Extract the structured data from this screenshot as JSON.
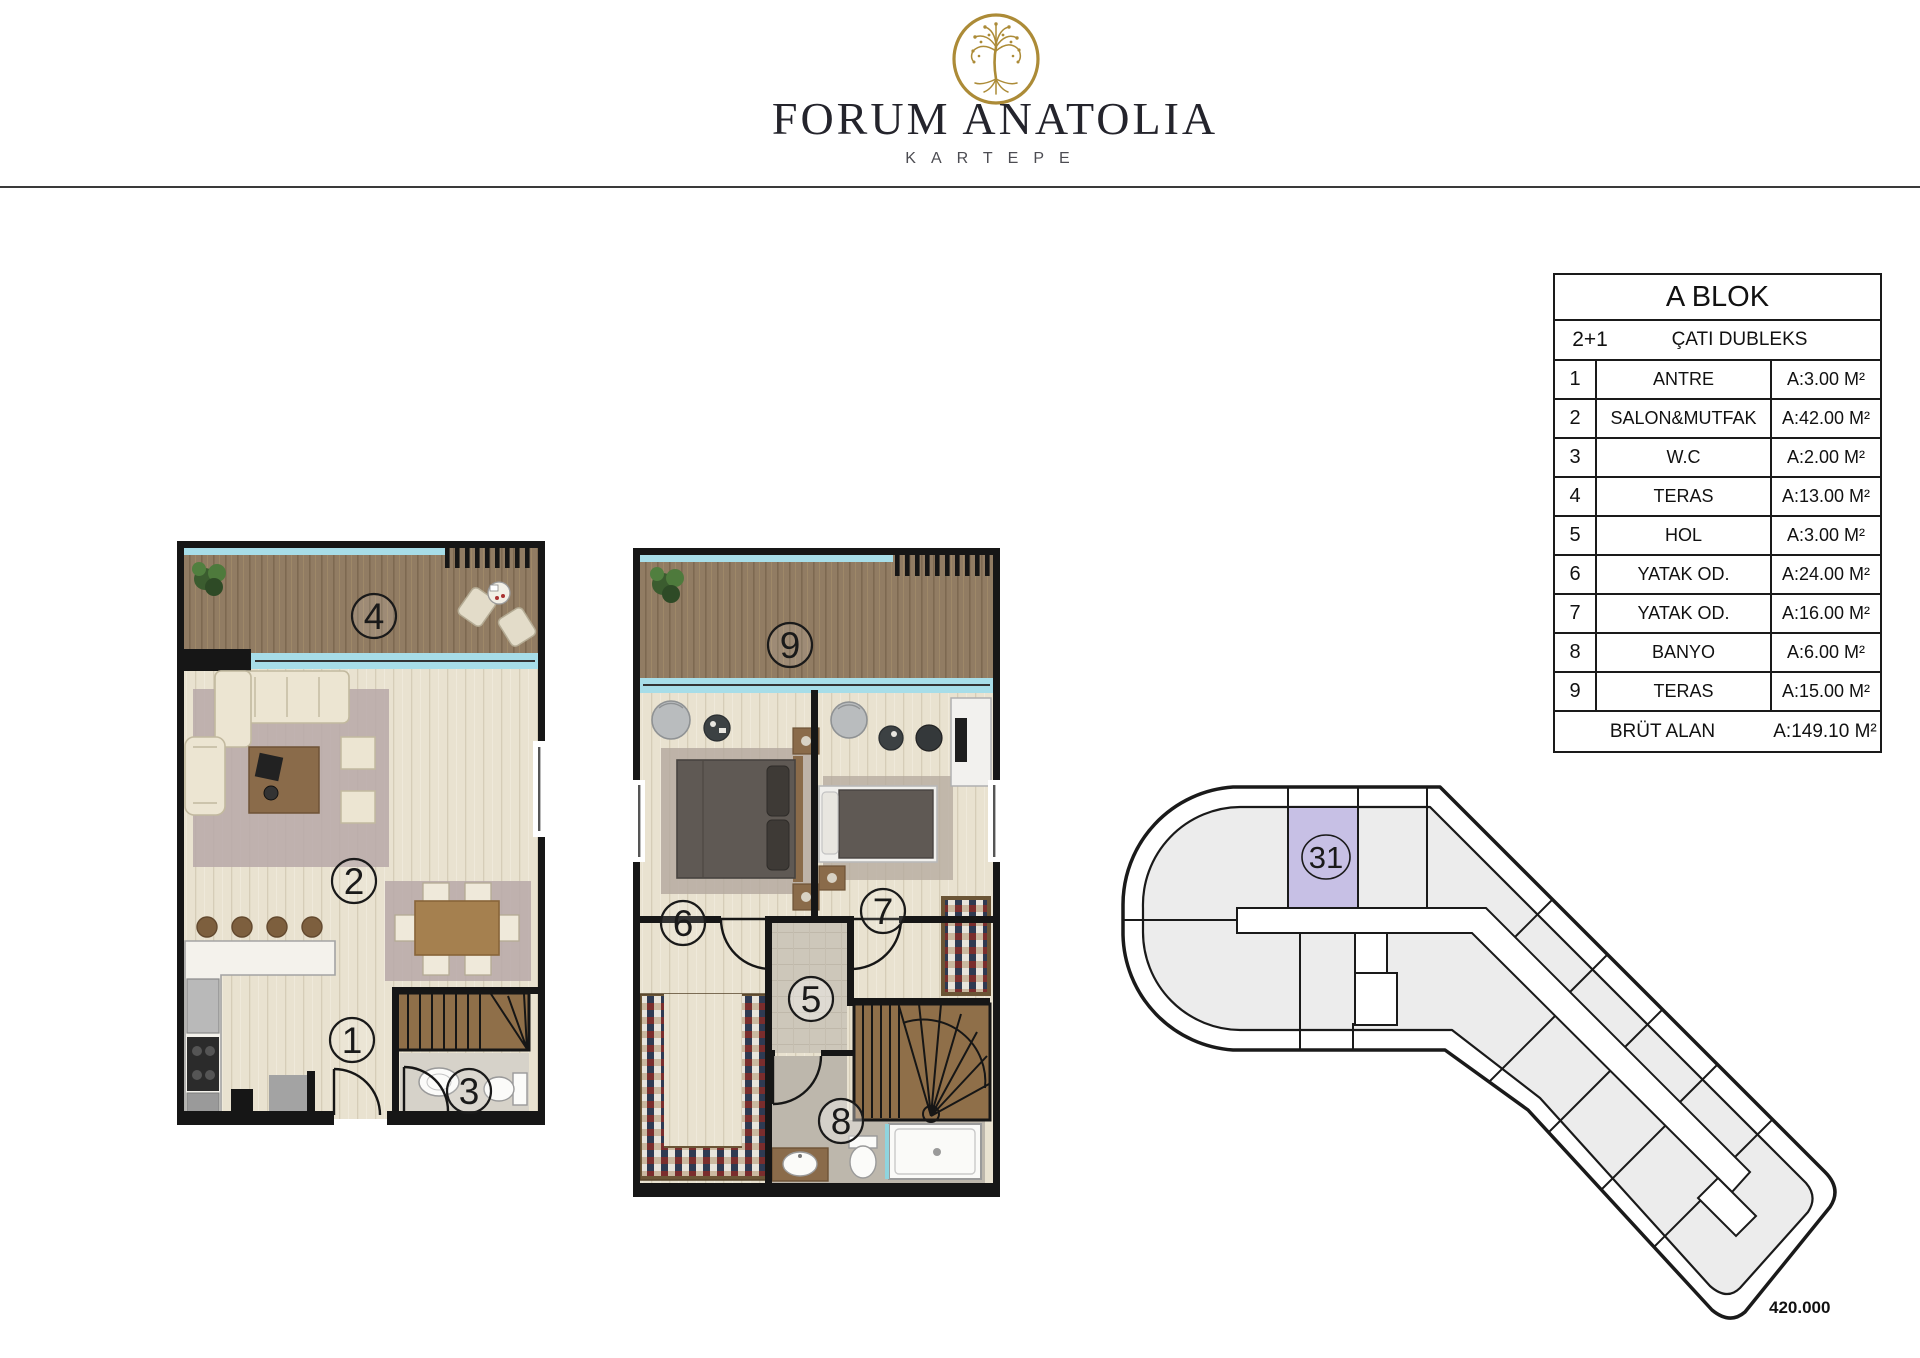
{
  "header": {
    "brand": "FORUM ANATOLIA",
    "location": "KARTEPE",
    "logo": "tree-of-life-logo",
    "logo_color": "#ac8b37"
  },
  "info_table": {
    "title": "A BLOK",
    "unit_type": "2+1",
    "unit_type_label": "ÇATI DUBLEKS",
    "rows": [
      {
        "no": "1",
        "name": "ANTRE",
        "area": "A:3.00 M²"
      },
      {
        "no": "2",
        "name": "SALON&MUTFAK",
        "area": "A:42.00 M²"
      },
      {
        "no": "3",
        "name": "W.C",
        "area": "A:2.00 M²"
      },
      {
        "no": "4",
        "name": "TERAS",
        "area": "A:13.00 M²"
      },
      {
        "no": "5",
        "name": "HOL",
        "area": "A:3.00 M²"
      },
      {
        "no": "6",
        "name": "YATAK OD.",
        "area": "A:24.00 M²"
      },
      {
        "no": "7",
        "name": "YATAK OD.",
        "area": "A:16.00 M²"
      },
      {
        "no": "8",
        "name": "BANYO",
        "area": "A:6.00 M²"
      },
      {
        "no": "9",
        "name": "TERAS",
        "area": "A:15.00 M²"
      }
    ],
    "total_label": "BRÜT ALAN",
    "total_area": "A:149.10 M²"
  },
  "floorplan_lower": {
    "description": "lower duplex floor: terrace, salon & kitchen, entry, wc, stairs",
    "room_labels": [
      "4",
      "2",
      "1",
      "3"
    ]
  },
  "floorplan_upper": {
    "description": "upper duplex floor: terrace, bedrooms, hall, bathroom, stairs",
    "room_labels": [
      "9",
      "6",
      "7",
      "5",
      "8"
    ]
  },
  "key_plan": {
    "highlighted_unit": "31",
    "highlight_color": "#c7c0e5"
  },
  "footer": {
    "price": "420.000"
  },
  "colors": {
    "accent_glass": "#a7dde8",
    "terrace_wood": "#917c63",
    "interior_floor": "#e9e2d0",
    "walls": "#161616",
    "unit_fill": "#ececec",
    "logo_gold": "#ac8b37"
  }
}
